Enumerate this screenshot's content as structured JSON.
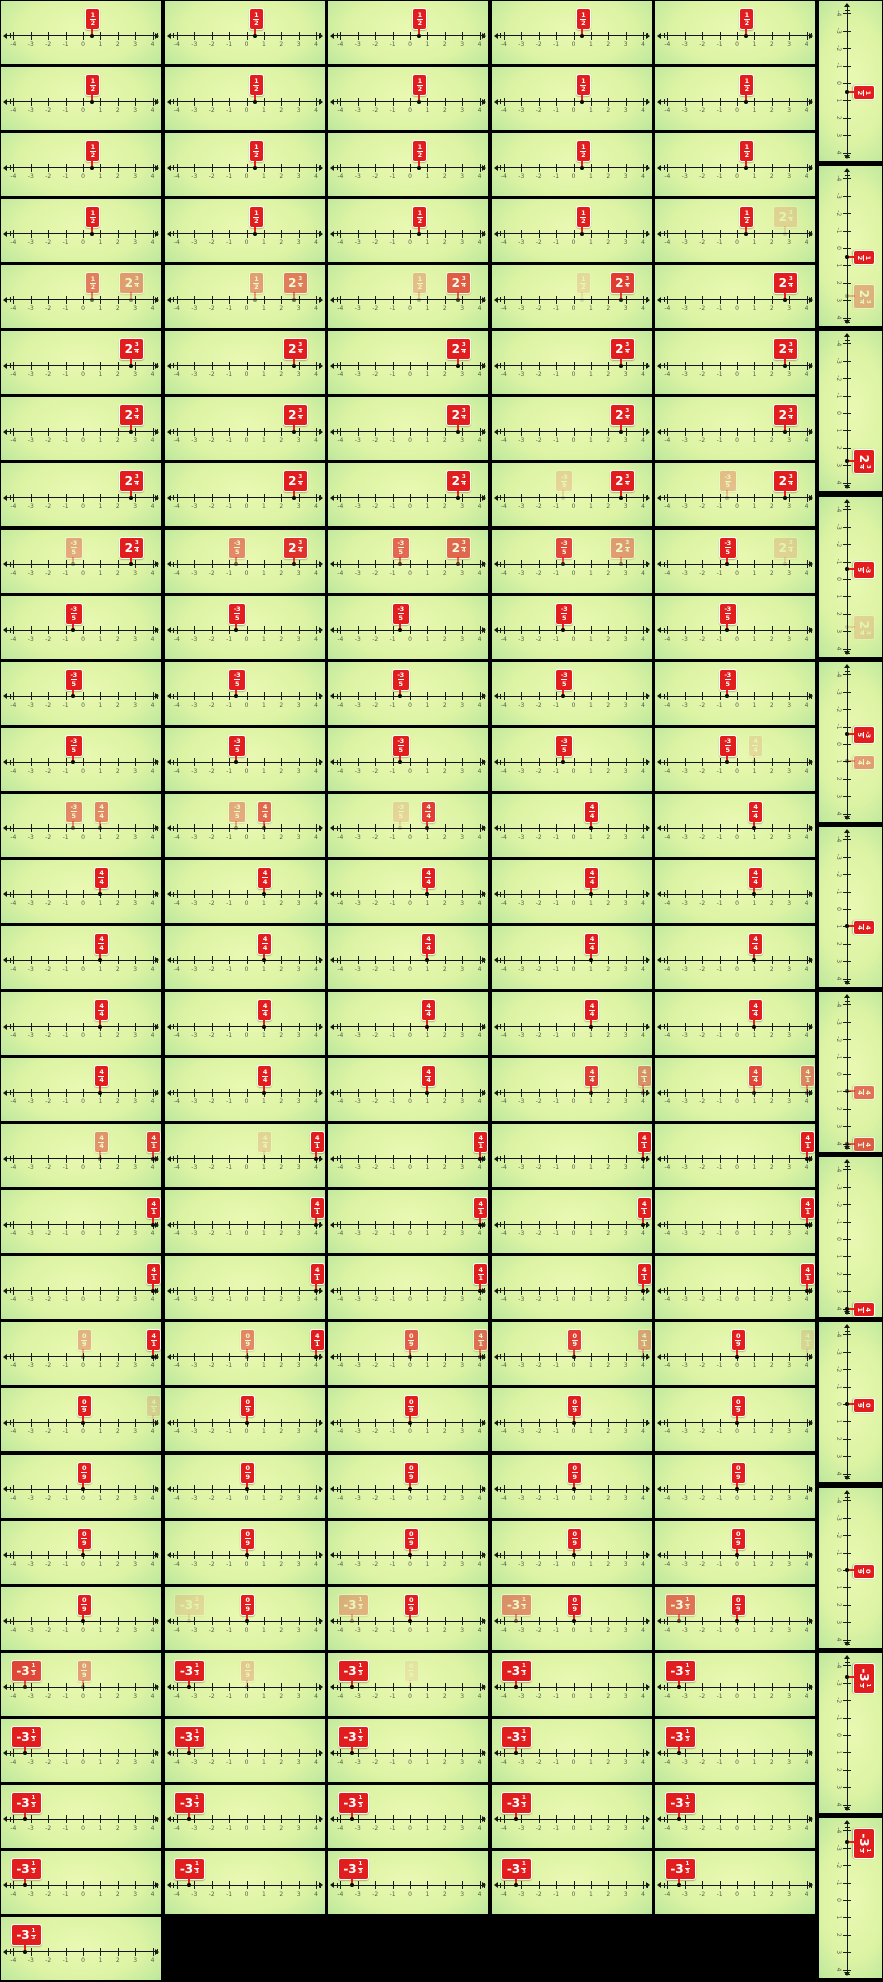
{
  "palette": {
    "sheet_bg": "#000000",
    "cell_bg_center": "#e9f9b2",
    "cell_bg_edge": "#54bb86",
    "flag_red": "#e11d1d",
    "flag_text": "#ffffff",
    "line_color": "#151515",
    "tick_label_color": "#3b4436"
  },
  "axis": {
    "min": -4,
    "max": 4,
    "ticks": [
      -4,
      -3,
      -2,
      -1,
      0,
      1,
      2,
      3,
      4
    ],
    "tick_labels": [
      "-4",
      "-3",
      "-2",
      "-1",
      "0",
      "1",
      "2",
      "3",
      "4"
    ]
  },
  "fractions": {
    "f12": {
      "display": "1/2",
      "whole": "",
      "num": "1",
      "den": "2",
      "value": 0.5,
      "w": 13
    },
    "f234": {
      "display": "2 3/4",
      "whole": "2",
      "num": "3",
      "den": "4",
      "value": 2.75,
      "w": 23
    },
    "fn35": {
      "display": "-3/5",
      "whole": "",
      "num": "-3",
      "den": "5",
      "value": -0.6,
      "w": 16
    },
    "f44": {
      "display": "4/4",
      "whole": "",
      "num": "4",
      "den": "4",
      "value": 1,
      "w": 13
    },
    "f41": {
      "display": "4/1",
      "whole": "",
      "num": "4",
      "den": "1",
      "value": 4,
      "w": 13
    },
    "f09": {
      "display": "0/9",
      "whole": "",
      "num": "0",
      "den": "9",
      "value": 0,
      "w": 13
    },
    "fn313": {
      "display": "-3 1/3",
      "whole": "-3",
      "num": "1",
      "den": "3",
      "value": -3.3333,
      "w": 29
    }
  },
  "grid": {
    "cols": 5,
    "rows": 30,
    "cells": [
      [
        [
          [
            "f12",
            1
          ]
        ],
        [
          [
            "f12",
            1
          ]
        ],
        [
          [
            "f12",
            1
          ]
        ],
        [
          [
            "f12",
            1
          ]
        ],
        [
          [
            "f12",
            1
          ]
        ]
      ],
      [
        [
          [
            "f12",
            1
          ]
        ],
        [
          [
            "f12",
            1
          ]
        ],
        [
          [
            "f12",
            1
          ]
        ],
        [
          [
            "f12",
            1
          ]
        ],
        [
          [
            "f12",
            1
          ]
        ]
      ],
      [
        [
          [
            "f12",
            1
          ]
        ],
        [
          [
            "f12",
            1
          ]
        ],
        [
          [
            "f12",
            1
          ]
        ],
        [
          [
            "f12",
            1
          ]
        ],
        [
          [
            "f12",
            1
          ]
        ]
      ],
      [
        [
          [
            "f12",
            1
          ]
        ],
        [
          [
            "f12",
            1
          ]
        ],
        [
          [
            "f12",
            1
          ]
        ],
        [
          [
            "f12",
            1
          ]
        ],
        [
          [
            "f12",
            1
          ],
          [
            "f234",
            0.15
          ]
        ]
      ],
      [
        [
          [
            "f12",
            0.55
          ],
          [
            "f234",
            0.4
          ]
        ],
        [
          [
            "f12",
            0.4
          ],
          [
            "f234",
            0.55
          ]
        ],
        [
          [
            "f12",
            0.25
          ],
          [
            "f234",
            0.7
          ]
        ],
        [
          [
            "f12",
            0.12
          ],
          [
            "f234",
            0.85
          ]
        ],
        [
          [
            "f234",
            1
          ]
        ]
      ],
      [
        [
          [
            "f234",
            1
          ]
        ],
        [
          [
            "f234",
            1
          ]
        ],
        [
          [
            "f234",
            1
          ]
        ],
        [
          [
            "f234",
            1
          ]
        ],
        [
          [
            "f234",
            1
          ]
        ]
      ],
      [
        [
          [
            "f234",
            1
          ]
        ],
        [
          [
            "f234",
            1
          ]
        ],
        [
          [
            "f234",
            1
          ]
        ],
        [
          [
            "f234",
            1
          ]
        ],
        [
          [
            "f234",
            1
          ]
        ]
      ],
      [
        [
          [
            "f234",
            1
          ]
        ],
        [
          [
            "f234",
            1
          ]
        ],
        [
          [
            "f234",
            1
          ]
        ],
        [
          [
            "f234",
            1
          ],
          [
            "fn35",
            0.15
          ]
        ],
        [
          [
            "f234",
            1
          ],
          [
            "fn35",
            0.25
          ]
        ]
      ],
      [
        [
          [
            "f234",
            1
          ],
          [
            "fn35",
            0.35
          ]
        ],
        [
          [
            "f234",
            0.9
          ],
          [
            "fn35",
            0.5
          ]
        ],
        [
          [
            "f234",
            0.65
          ],
          [
            "fn35",
            0.65
          ]
        ],
        [
          [
            "f234",
            0.4
          ],
          [
            "fn35",
            0.8
          ]
        ],
        [
          [
            "f234",
            0.15
          ],
          [
            "fn35",
            1
          ]
        ]
      ],
      [
        [
          [
            "fn35",
            1
          ]
        ],
        [
          [
            "fn35",
            1
          ]
        ],
        [
          [
            "fn35",
            1
          ]
        ],
        [
          [
            "fn35",
            1
          ]
        ],
        [
          [
            "fn35",
            1
          ]
        ]
      ],
      [
        [
          [
            "fn35",
            1
          ]
        ],
        [
          [
            "fn35",
            1
          ]
        ],
        [
          [
            "fn35",
            1
          ]
        ],
        [
          [
            "fn35",
            1
          ]
        ],
        [
          [
            "fn35",
            1
          ]
        ]
      ],
      [
        [
          [
            "fn35",
            1
          ]
        ],
        [
          [
            "fn35",
            1
          ]
        ],
        [
          [
            "fn35",
            1
          ]
        ],
        [
          [
            "fn35",
            1
          ]
        ],
        [
          [
            "fn35",
            1
          ],
          [
            "f44",
            0.12
          ]
        ]
      ],
      [
        [
          [
            "fn35",
            0.5
          ],
          [
            "f44",
            0.5
          ]
        ],
        [
          [
            "fn35",
            0.35
          ],
          [
            "f44",
            0.65
          ]
        ],
        [
          [
            "fn35",
            0.15
          ],
          [
            "f44",
            0.85
          ]
        ],
        [
          [
            "f44",
            1
          ]
        ],
        [
          [
            "f44",
            1
          ]
        ]
      ],
      [
        [
          [
            "f44",
            1
          ]
        ],
        [
          [
            "f44",
            1
          ]
        ],
        [
          [
            "f44",
            1
          ]
        ],
        [
          [
            "f44",
            1
          ]
        ],
        [
          [
            "f44",
            1
          ]
        ]
      ],
      [
        [
          [
            "f44",
            1
          ]
        ],
        [
          [
            "f44",
            1
          ]
        ],
        [
          [
            "f44",
            1
          ]
        ],
        [
          [
            "f44",
            1
          ]
        ],
        [
          [
            "f44",
            1
          ]
        ]
      ],
      [
        [
          [
            "f44",
            1
          ]
        ],
        [
          [
            "f44",
            1
          ]
        ],
        [
          [
            "f44",
            1
          ]
        ],
        [
          [
            "f44",
            1
          ]
        ],
        [
          [
            "f44",
            1
          ]
        ]
      ],
      [
        [
          [
            "f44",
            1
          ]
        ],
        [
          [
            "f44",
            1
          ]
        ],
        [
          [
            "f44",
            1
          ]
        ],
        [
          [
            "f44",
            0.85
          ],
          [
            "f41",
            0.45
          ]
        ],
        [
          [
            "f44",
            0.8
          ],
          [
            "f41",
            0.5
          ]
        ]
      ],
      [
        [
          [
            "f44",
            0.45
          ],
          [
            "f41",
            0.85
          ]
        ],
        [
          [
            "f44",
            0.15
          ],
          [
            "f41",
            1
          ]
        ],
        [
          [
            "f41",
            1
          ]
        ],
        [
          [
            "f41",
            1
          ]
        ],
        [
          [
            "f41",
            1
          ]
        ]
      ],
      [
        [
          [
            "f41",
            1
          ]
        ],
        [
          [
            "f41",
            1
          ]
        ],
        [
          [
            "f41",
            1
          ]
        ],
        [
          [
            "f41",
            1
          ]
        ],
        [
          [
            "f41",
            1
          ]
        ]
      ],
      [
        [
          [
            "f41",
            1
          ]
        ],
        [
          [
            "f41",
            1
          ]
        ],
        [
          [
            "f41",
            1
          ]
        ],
        [
          [
            "f41",
            1
          ]
        ],
        [
          [
            "f41",
            1
          ]
        ]
      ],
      [
        [
          [
            "f41",
            1
          ],
          [
            "f09",
            0.3
          ]
        ],
        [
          [
            "f41",
            1
          ],
          [
            "f09",
            0.5
          ]
        ],
        [
          [
            "f41",
            0.6
          ],
          [
            "f09",
            0.7
          ]
        ],
        [
          [
            "f41",
            0.35
          ],
          [
            "f09",
            0.85
          ]
        ],
        [
          [
            "f41",
            0.12
          ],
          [
            "f09",
            1
          ]
        ]
      ],
      [
        [
          [
            "f09",
            1
          ],
          [
            "f41",
            0.15
          ]
        ],
        [
          [
            "f09",
            1
          ]
        ],
        [
          [
            "f09",
            1
          ]
        ],
        [
          [
            "f09",
            1
          ]
        ],
        [
          [
            "f09",
            1
          ]
        ]
      ],
      [
        [
          [
            "f09",
            1
          ]
        ],
        [
          [
            "f09",
            1
          ]
        ],
        [
          [
            "f09",
            1
          ]
        ],
        [
          [
            "f09",
            1
          ]
        ],
        [
          [
            "f09",
            1
          ]
        ]
      ],
      [
        [
          [
            "f09",
            1
          ]
        ],
        [
          [
            "f09",
            1
          ]
        ],
        [
          [
            "f09",
            1
          ]
        ],
        [
          [
            "f09",
            1
          ]
        ],
        [
          [
            "f09",
            1
          ]
        ]
      ],
      [
        [
          [
            "f09",
            1
          ]
        ],
        [
          [
            "f09",
            1
          ],
          [
            "fn313",
            0.12
          ]
        ],
        [
          [
            "f09",
            1
          ],
          [
            "fn313",
            0.3
          ]
        ],
        [
          [
            "f09",
            1
          ],
          [
            "fn313",
            0.45
          ]
        ],
        [
          [
            "f09",
            1
          ],
          [
            "fn313",
            0.6
          ]
        ]
      ],
      [
        [
          [
            "fn313",
            0.8
          ],
          [
            "f09",
            0.4
          ]
        ],
        [
          [
            "fn313",
            1
          ],
          [
            "f09",
            0.2
          ]
        ],
        [
          [
            "fn313",
            1
          ],
          [
            "f09",
            0.08
          ]
        ],
        [
          [
            "fn313",
            1
          ]
        ],
        [
          [
            "fn313",
            1
          ]
        ]
      ],
      [
        [
          [
            "fn313",
            1
          ]
        ],
        [
          [
            "fn313",
            1
          ]
        ],
        [
          [
            "fn313",
            1
          ]
        ],
        [
          [
            "fn313",
            1
          ]
        ],
        [
          [
            "fn313",
            1
          ]
        ]
      ],
      [
        [
          [
            "fn313",
            1
          ]
        ],
        [
          [
            "fn313",
            1
          ]
        ],
        [
          [
            "fn313",
            1
          ]
        ],
        [
          [
            "fn313",
            1
          ]
        ],
        [
          [
            "fn313",
            1
          ]
        ]
      ],
      [
        [
          [
            "fn313",
            1
          ]
        ],
        [
          [
            "fn313",
            1
          ]
        ],
        [
          [
            "fn313",
            1
          ]
        ],
        [
          [
            "fn313",
            1
          ]
        ],
        [
          [
            "fn313",
            1
          ]
        ]
      ],
      [
        [
          [
            "fn313",
            1
          ]
        ],
        null,
        null,
        null,
        null
      ]
    ]
  },
  "side_strip": {
    "cells": [
      [
        [
          "f12",
          1
        ]
      ],
      [
        [
          "f12",
          1
        ],
        [
          "f234",
          0.3
        ]
      ],
      [
        [
          "f234",
          1
        ]
      ],
      [
        [
          "fn35",
          1
        ],
        [
          "f234",
          0.15
        ]
      ],
      [
        [
          "fn35",
          1
        ],
        [
          "f44",
          0.4
        ]
      ],
      [
        [
          "f44",
          1
        ]
      ],
      [
        [
          "f44",
          0.6
        ],
        [
          "f41",
          0.7
        ]
      ],
      [
        [
          "f41",
          1
        ]
      ],
      [
        [
          "f09",
          1
        ]
      ],
      [
        [
          "f09",
          1
        ]
      ],
      [
        [
          "fn313",
          1
        ]
      ],
      [
        [
          "fn313",
          1
        ]
      ]
    ]
  }
}
